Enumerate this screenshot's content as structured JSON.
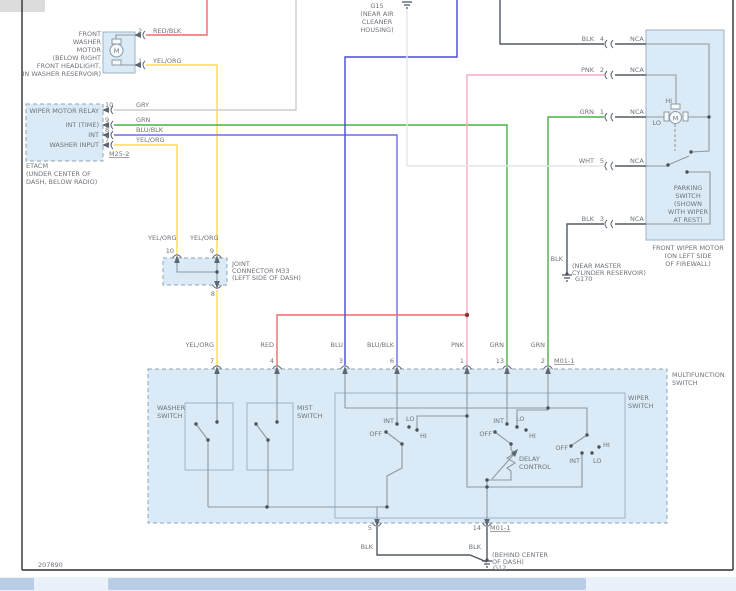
{
  "title": "Wiper / Washer Wiring Diagram",
  "wire_colors": {
    "red": "#f0696c",
    "yellow": "#ffdf43",
    "gray": "#c9cdd1",
    "green": "#4daf4a",
    "blue": "#4848e0",
    "blue_black": "#6d6de4",
    "pink": "#f6abc1",
    "white": "#e3e6e8",
    "black": "#515a62"
  },
  "colors": {
    "component_fill": "#dbeaf7",
    "frame": "#2e2e2e",
    "text": "#6e747a"
  },
  "texts": [
    {
      "n": "washer-motor-caption-line1",
      "t": "FRONT",
      "x": 101,
      "y": 36,
      "a": "end"
    },
    {
      "n": "washer-motor-caption-line2",
      "t": "WASHER",
      "x": 101,
      "y": 44,
      "a": "end"
    },
    {
      "n": "washer-motor-caption-line3",
      "t": "MOTOR",
      "x": 101,
      "y": 52,
      "a": "end"
    },
    {
      "n": "washer-motor-caption-line4",
      "t": "(BELOW RIGHT",
      "x": 101,
      "y": 60,
      "a": "end"
    },
    {
      "n": "washer-motor-caption-line5",
      "t": "FRONT HEADLIGHT,",
      "x": 101,
      "y": 68,
      "a": "end"
    },
    {
      "n": "washer-motor-caption-line6",
      "t": "IN WASHER RESERVOIR)",
      "x": 101,
      "y": 76,
      "a": "end"
    },
    {
      "n": "washer-motor-pin-2",
      "t": "2",
      "x": 138,
      "y": 33
    },
    {
      "n": "wire-label-red-blk",
      "t": "RED/BLK",
      "x": 153,
      "y": 33
    },
    {
      "n": "washer-motor-pin-1",
      "t": "1",
      "x": 138,
      "y": 63
    },
    {
      "n": "wire-label-yel-org-1",
      "t": "YEL/ORG",
      "x": 153,
      "y": 63
    },
    {
      "n": "washer-motor-letter",
      "t": "M",
      "x": 116.5,
      "y": 53,
      "a": "middle",
      "s": 7
    },
    {
      "n": "etacm-row-wiper-motor-relay",
      "t": "WIPER MOTOR RELAY",
      "x": 99,
      "y": 113,
      "a": "end"
    },
    {
      "n": "etacm-row-int-time",
      "t": "INT (TIME)",
      "x": 99,
      "y": 127,
      "a": "end"
    },
    {
      "n": "etacm-row-int",
      "t": "INT",
      "x": 99,
      "y": 137,
      "a": "end"
    },
    {
      "n": "etacm-row-washer-input",
      "t": "WASHER INPUT",
      "x": 99,
      "y": 147,
      "a": "end"
    },
    {
      "n": "etacm-pin-10",
      "t": "10",
      "x": 105,
      "y": 107
    },
    {
      "n": "etacm-pin-9",
      "t": "9",
      "x": 105,
      "y": 122
    },
    {
      "n": "etacm-pin-8",
      "t": "8",
      "x": 105,
      "y": 132
    },
    {
      "n": "etacm-pin-7",
      "t": "7",
      "x": 105,
      "y": 142
    },
    {
      "n": "wire-label-gry",
      "t": "GRY",
      "x": 136,
      "y": 107
    },
    {
      "n": "wire-label-grn-1",
      "t": "GRN",
      "x": 136,
      "y": 122
    },
    {
      "n": "wire-label-blu-blk-1",
      "t": "BLU/BLK",
      "x": 136,
      "y": 132
    },
    {
      "n": "wire-label-yel-org-2",
      "t": "YEL/ORG",
      "x": 136,
      "y": 142
    },
    {
      "n": "etacm-connector-id",
      "t": "M25-2",
      "x": 109,
      "y": 156,
      "u": true
    },
    {
      "n": "etacm-caption-line1",
      "t": "ETACM",
      "x": 26,
      "y": 168
    },
    {
      "n": "etacm-caption-line2",
      "t": "(UNDER CENTER OF",
      "x": 26,
      "y": 176
    },
    {
      "n": "etacm-caption-line3",
      "t": "DASH, BELOW RADIO)",
      "x": 26,
      "y": 184
    },
    {
      "n": "g15-label",
      "t": "G15",
      "x": 377,
      "y": 8,
      "a": "middle"
    },
    {
      "n": "g15-caption-line1",
      "t": "(NEAR AIR",
      "x": 377,
      "y": 16,
      "a": "middle"
    },
    {
      "n": "g15-caption-line2",
      "t": "CLEANER",
      "x": 377,
      "y": 24,
      "a": "middle"
    },
    {
      "n": "g15-caption-line3",
      "t": "HOUSING)",
      "x": 377,
      "y": 32,
      "a": "middle"
    },
    {
      "n": "wiper-motor-wire-blk4",
      "t": "BLK",
      "x": 594,
      "y": 41,
      "a": "end"
    },
    {
      "n": "wiper-motor-pin-4",
      "t": "4",
      "x": 604,
      "y": 41,
      "a": "end"
    },
    {
      "n": "nca-label-1",
      "t": "NCA",
      "x": 630,
      "y": 41
    },
    {
      "n": "wiper-motor-wire-pnk",
      "t": "PNK",
      "x": 594,
      "y": 72,
      "a": "end"
    },
    {
      "n": "wiper-motor-pin-2",
      "t": "2",
      "x": 604,
      "y": 72,
      "a": "end"
    },
    {
      "n": "nca-label-2",
      "t": "NCA",
      "x": 630,
      "y": 72
    },
    {
      "n": "wiper-motor-wire-grn",
      "t": "GRN",
      "x": 594,
      "y": 114,
      "a": "end"
    },
    {
      "n": "wiper-motor-pin-1",
      "t": "1",
      "x": 604,
      "y": 114,
      "a": "end"
    },
    {
      "n": "nca-label-3",
      "t": "NCA",
      "x": 630,
      "y": 114
    },
    {
      "n": "wiper-motor-wire-wht",
      "t": "WHT",
      "x": 594,
      "y": 163,
      "a": "end"
    },
    {
      "n": "wiper-motor-pin-5",
      "t": "5",
      "x": 604,
      "y": 163,
      "a": "end"
    },
    {
      "n": "nca-label-4",
      "t": "NCA",
      "x": 630,
      "y": 163
    },
    {
      "n": "wiper-motor-wire-blk3",
      "t": "BLK",
      "x": 594,
      "y": 221,
      "a": "end"
    },
    {
      "n": "wiper-motor-pin-3",
      "t": "3",
      "x": 604,
      "y": 221,
      "a": "end"
    },
    {
      "n": "nca-label-5",
      "t": "NCA",
      "x": 630,
      "y": 221
    },
    {
      "n": "wiper-motor-hi-label",
      "t": "HI",
      "x": 672,
      "y": 103,
      "a": "end",
      "s": 6
    },
    {
      "n": "wiper-motor-lo-label",
      "t": "LO",
      "x": 661,
      "y": 125,
      "a": "end",
      "s": 6
    },
    {
      "n": "wiper-motor-letter",
      "t": "M",
      "x": 675.5,
      "y": 120.5,
      "a": "middle",
      "s": 7
    },
    {
      "n": "parking-switch-caption-line1",
      "t": "PARKING",
      "x": 688,
      "y": 190,
      "a": "middle"
    },
    {
      "n": "parking-switch-caption-line2",
      "t": "SWITCH",
      "x": 688,
      "y": 198,
      "a": "middle"
    },
    {
      "n": "parking-switch-caption-line3",
      "t": "(SHOWN",
      "x": 688,
      "y": 206,
      "a": "middle"
    },
    {
      "n": "parking-switch-caption-line4",
      "t": "WITH WIPER",
      "x": 688,
      "y": 214,
      "a": "middle"
    },
    {
      "n": "parking-switch-caption-line5",
      "t": "AT REST)",
      "x": 688,
      "y": 222,
      "a": "middle"
    },
    {
      "n": "wiper-motor-caption-line1",
      "t": "FRONT WIPER MOTOR",
      "x": 688,
      "y": 250,
      "a": "middle"
    },
    {
      "n": "wiper-motor-caption-line2",
      "t": "(ON LEFT SIDE",
      "x": 688,
      "y": 258,
      "a": "middle"
    },
    {
      "n": "wiper-motor-caption-line3",
      "t": "OF FIREWALL)",
      "x": 688,
      "y": 266,
      "a": "middle"
    },
    {
      "n": "g170-wire-label",
      "t": "BLK",
      "x": 563,
      "y": 261,
      "a": "end"
    },
    {
      "n": "g170-caption-line1",
      "t": "(NEAR MASTER",
      "x": 572,
      "y": 268
    },
    {
      "n": "g170-caption-line2",
      "t": "CYLINDER RESERVOIR)",
      "x": 572,
      "y": 275
    },
    {
      "n": "g170-label",
      "t": "G170",
      "x": 575,
      "y": 281
    },
    {
      "n": "m33-wire-label-left",
      "t": "YEL/ORG",
      "x": 148,
      "y": 240
    },
    {
      "n": "m33-wire-label-right",
      "t": "YEL/ORG",
      "x": 190,
      "y": 240
    },
    {
      "n": "m33-pin-10",
      "t": "10",
      "x": 174,
      "y": 253,
      "a": "end"
    },
    {
      "n": "m33-pin-9",
      "t": "9",
      "x": 214,
      "y": 253,
      "a": "end"
    },
    {
      "n": "m33-pin-8",
      "t": "8",
      "x": 215,
      "y": 296,
      "a": "end"
    },
    {
      "n": "m33-caption-line1",
      "t": "JOINT",
      "x": 232,
      "y": 266
    },
    {
      "n": "m33-caption-line2",
      "t": "CONNECTOR M33",
      "x": 232,
      "y": 273
    },
    {
      "n": "m33-caption-line3",
      "t": "(LEFT SIDE OF DASH)",
      "x": 232,
      "y": 280
    },
    {
      "n": "mf-wire-label-yel-org",
      "t": "YEL/ORG",
      "x": 214,
      "y": 347,
      "a": "end"
    },
    {
      "n": "mf-wire-label-red",
      "t": "RED",
      "x": 274,
      "y": 347,
      "a": "end"
    },
    {
      "n": "mf-wire-label-blu",
      "t": "BLU",
      "x": 343,
      "y": 347,
      "a": "end"
    },
    {
      "n": "mf-wire-label-blu-blk",
      "t": "BLU/BLK",
      "x": 394,
      "y": 347,
      "a": "end"
    },
    {
      "n": "mf-wire-label-pnk",
      "t": "PNK",
      "x": 464,
      "y": 347,
      "a": "end"
    },
    {
      "n": "mf-wire-label-grn-13",
      "t": "GRN",
      "x": 504,
      "y": 347,
      "a": "end"
    },
    {
      "n": "mf-wire-label-grn-2",
      "t": "GRN",
      "x": 545,
      "y": 347,
      "a": "end"
    },
    {
      "n": "mf-pin-7",
      "t": "7",
      "x": 214,
      "y": 363,
      "a": "end"
    },
    {
      "n": "mf-pin-4",
      "t": "4",
      "x": 274,
      "y": 363,
      "a": "end"
    },
    {
      "n": "mf-pin-3",
      "t": "3",
      "x": 343,
      "y": 363,
      "a": "end"
    },
    {
      "n": "mf-pin-6",
      "t": "6",
      "x": 394,
      "y": 363,
      "a": "end"
    },
    {
      "n": "mf-pin-1",
      "t": "1",
      "x": 464,
      "y": 363,
      "a": "end"
    },
    {
      "n": "mf-pin-13",
      "t": "13",
      "x": 504,
      "y": 363,
      "a": "end"
    },
    {
      "n": "mf-pin-2",
      "t": "2",
      "x": 545,
      "y": 363,
      "a": "end"
    },
    {
      "n": "mf-connector-id-top",
      "t": "M01-1",
      "x": 554,
      "y": 363,
      "u": true
    },
    {
      "n": "mf-switch-caption-line1",
      "t": "MULTIFUNCTION",
      "x": 672,
      "y": 377
    },
    {
      "n": "mf-switch-caption-line2",
      "t": "SWITCH",
      "x": 672,
      "y": 385
    },
    {
      "n": "washer-switch-label-line1",
      "t": "WASHER",
      "x": 157,
      "y": 410
    },
    {
      "n": "washer-switch-label-line2",
      "t": "SWITCH",
      "x": 157,
      "y": 418
    },
    {
      "n": "mist-switch-label-line1",
      "t": "MIST",
      "x": 297,
      "y": 410
    },
    {
      "n": "mist-switch-label-line2",
      "t": "SWITCH",
      "x": 297,
      "y": 418
    },
    {
      "n": "wiper-switch-label-line1",
      "t": "WIPER",
      "x": 628,
      "y": 400
    },
    {
      "n": "wiper-switch-label-line2",
      "t": "SWITCH",
      "x": 628,
      "y": 408
    },
    {
      "n": "sw1-int-label",
      "t": "INT",
      "x": 394,
      "y": 423,
      "a": "end",
      "s": 6
    },
    {
      "n": "sw1-lo-label",
      "t": "LO",
      "x": 406,
      "y": 421,
      "s": 6
    },
    {
      "n": "sw1-off-label",
      "t": "OFF",
      "x": 382,
      "y": 436,
      "a": "end",
      "s": 6
    },
    {
      "n": "sw1-hi-label",
      "t": "HI",
      "x": 420,
      "y": 438,
      "s": 6
    },
    {
      "n": "sw2-int-label",
      "t": "INT",
      "x": 504,
      "y": 423,
      "a": "end",
      "s": 6
    },
    {
      "n": "sw2-lo-label",
      "t": "LO",
      "x": 516,
      "y": 421,
      "s": 6
    },
    {
      "n": "sw2-off-label",
      "t": "OFF",
      "x": 492,
      "y": 436,
      "a": "end",
      "s": 6
    },
    {
      "n": "sw2-hi-label",
      "t": "HI",
      "x": 529,
      "y": 438,
      "s": 6
    },
    {
      "n": "sw3-off-label",
      "t": "OFF",
      "x": 568,
      "y": 450,
      "a": "end",
      "s": 6
    },
    {
      "n": "sw3-hi-label",
      "t": "HI",
      "x": 603,
      "y": 447,
      "s": 6
    },
    {
      "n": "sw3-int-label",
      "t": "INT",
      "x": 580,
      "y": 463,
      "a": "end",
      "s": 6
    },
    {
      "n": "sw3-lo-label",
      "t": "LO",
      "x": 593,
      "y": 463,
      "s": 6
    },
    {
      "n": "delay-control-label-line1",
      "t": "DELAY",
      "x": 519,
      "y": 461
    },
    {
      "n": "delay-control-label-line2",
      "t": "CONTROL",
      "x": 519,
      "y": 469
    },
    {
      "n": "mf-pin-5",
      "t": "5",
      "x": 372,
      "y": 530,
      "a": "end"
    },
    {
      "n": "mf-pin-14",
      "t": "14",
      "x": 481,
      "y": 530,
      "a": "end"
    },
    {
      "n": "mf-connector-id-bottom",
      "t": "M01-1",
      "x": 490,
      "y": 530,
      "u": true
    },
    {
      "n": "g12-wire-label-left",
      "t": "BLK",
      "x": 373,
      "y": 549,
      "a": "end"
    },
    {
      "n": "g12-wire-label-right",
      "t": "BLK",
      "x": 481,
      "y": 549,
      "a": "end"
    },
    {
      "n": "g12-caption-line1",
      "t": "(BEHIND CENTER",
      "x": 492,
      "y": 557
    },
    {
      "n": "g12-caption-line2",
      "t": "OF DASH)",
      "x": 492,
      "y": 564
    },
    {
      "n": "g12-label",
      "t": "G12",
      "x": 493,
      "y": 570
    },
    {
      "n": "document-number",
      "t": "207890",
      "x": 38,
      "y": 567
    }
  ]
}
